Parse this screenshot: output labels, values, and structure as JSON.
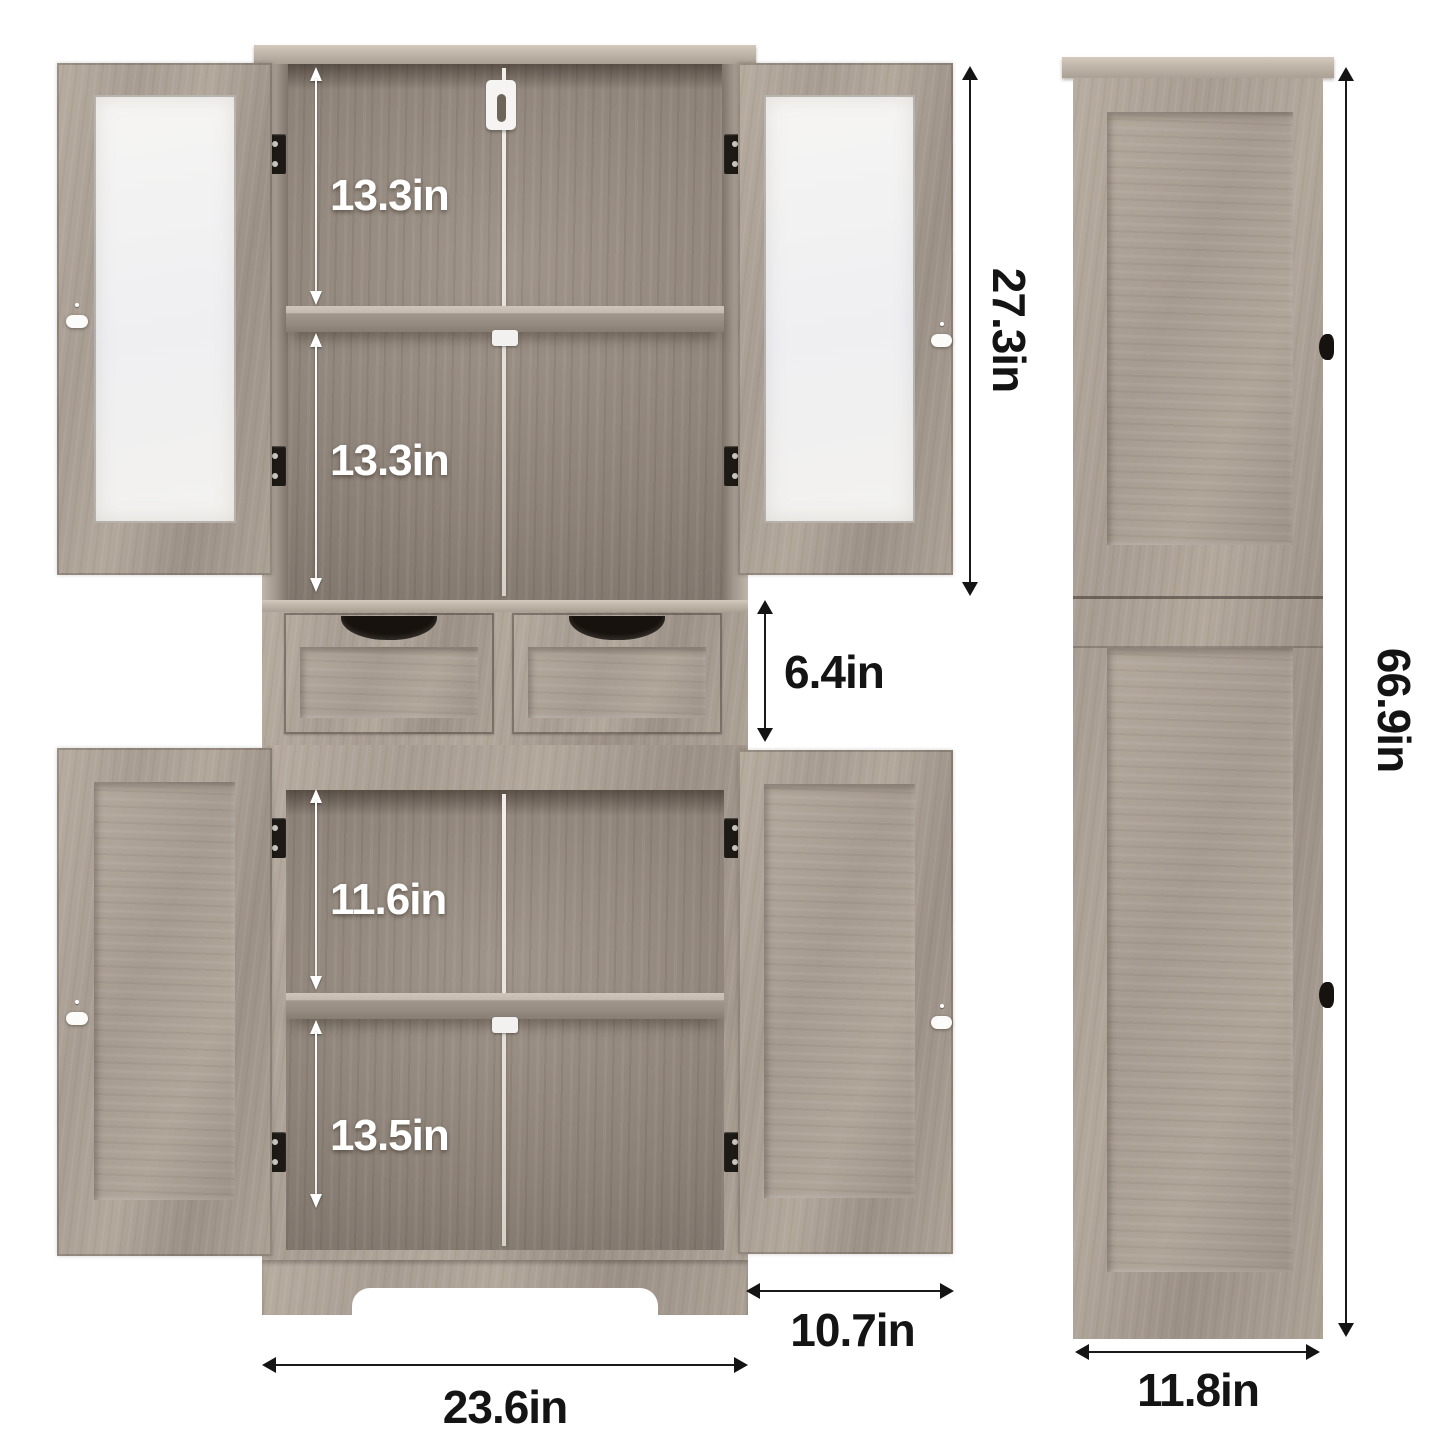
{
  "front_view": {
    "labels": {
      "upper_compartment_top": "13.3in",
      "upper_compartment_bottom": "13.3in",
      "upper_cabinet_height": "27.3in",
      "drawer_height": "6.4in",
      "lower_compartment_top": "11.6in",
      "lower_compartment_bottom": "13.5in",
      "door_width": "10.7in",
      "cabinet_width": "23.6in"
    }
  },
  "side_view": {
    "labels": {
      "total_height": "66.9in",
      "depth": "11.8in"
    }
  },
  "colors": {
    "background": "#ffffff",
    "wood": "#ab9f94",
    "wood_light": "#c6bcb0",
    "interior_dark": "#857a70",
    "glass": "#f4f3f1",
    "annotation_dark": "#141414",
    "annotation_light": "#ffffff",
    "hardware_black": "#17130f",
    "hardware_white": "#ffffff"
  }
}
